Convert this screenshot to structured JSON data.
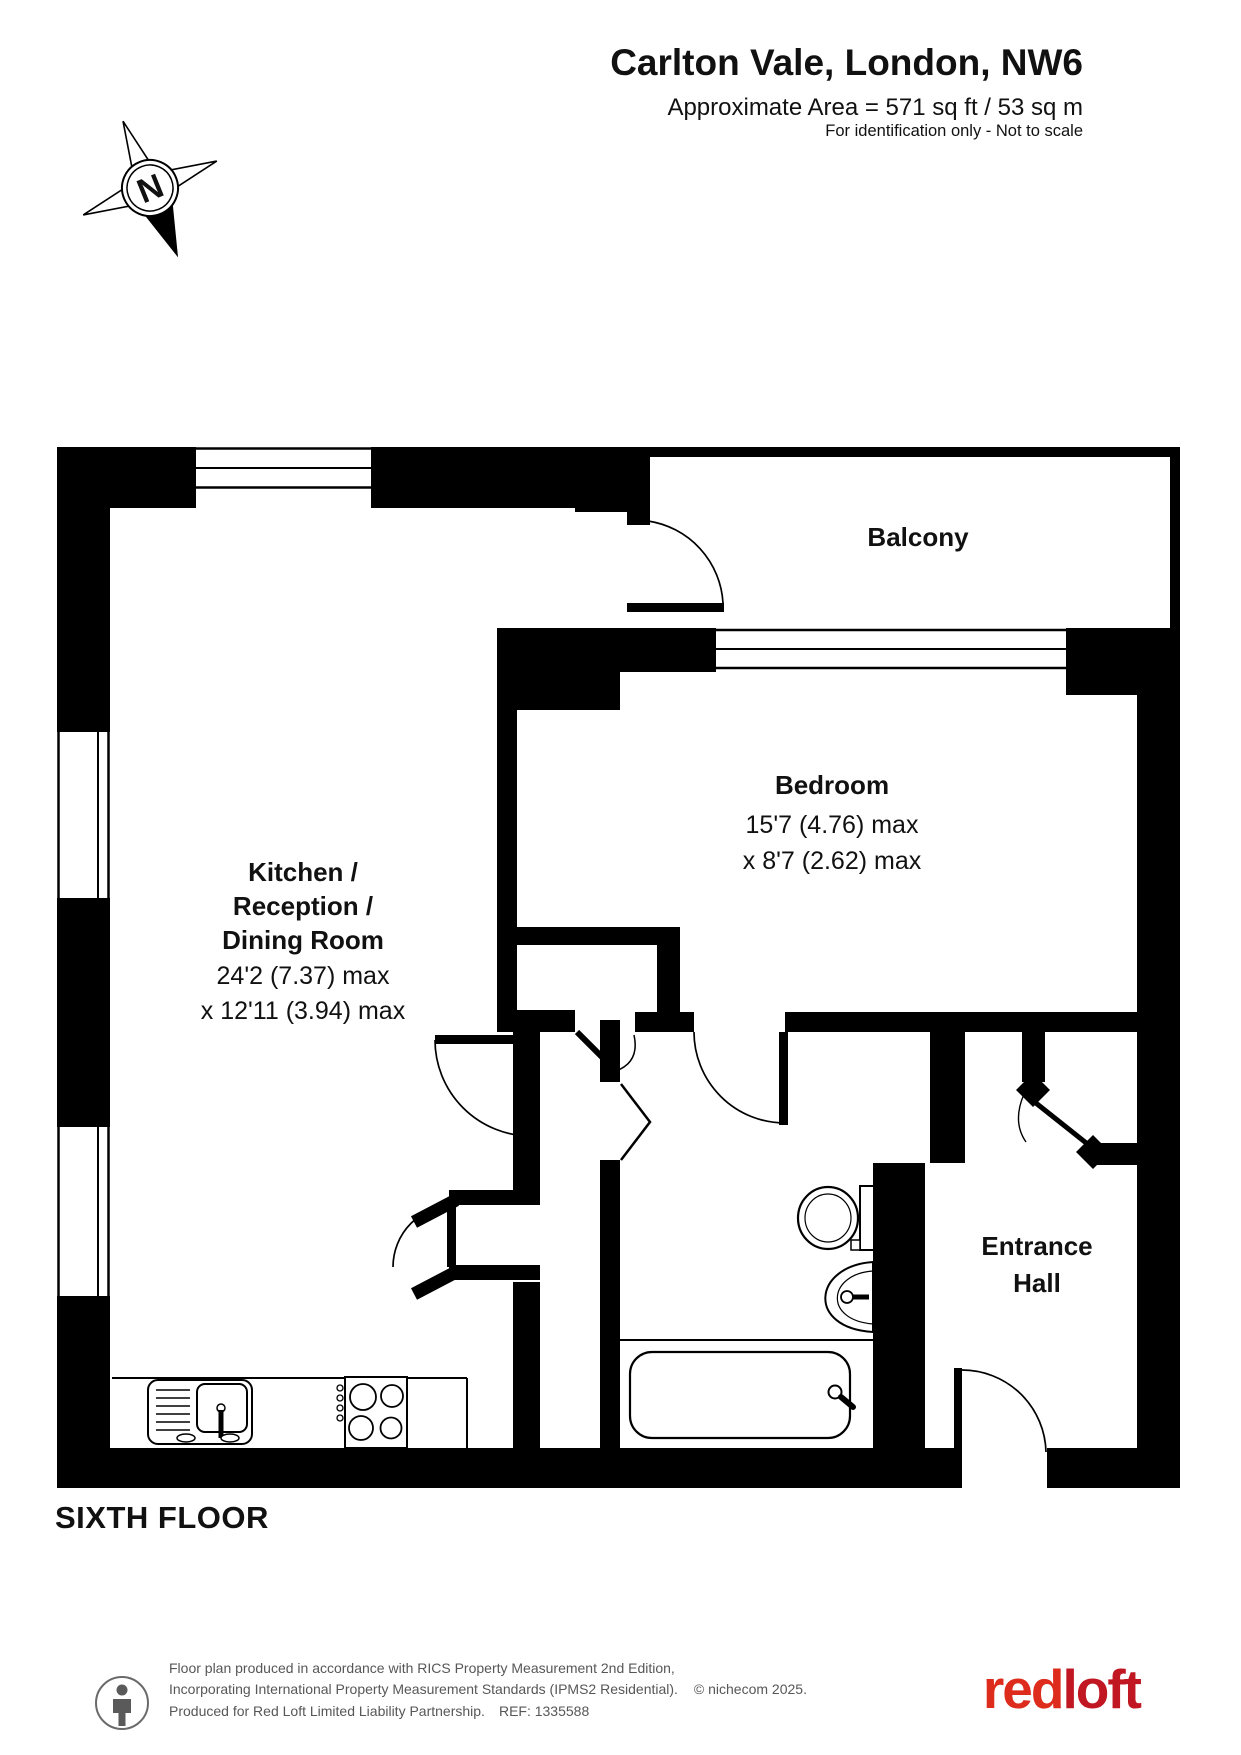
{
  "header": {
    "address": "Carlton Vale, London, NW6",
    "area": "Approximate Area = 571 sq ft / 53 sq m",
    "note": "For identification only - Not to scale"
  },
  "compass": {
    "label": "N"
  },
  "rooms": {
    "balcony": {
      "name": "Balcony"
    },
    "bedroom": {
      "name": "Bedroom",
      "dim1": "15'7 (4.76) max",
      "dim2": "x 8'7 (2.62) max"
    },
    "kitchen": {
      "line1": "Kitchen /",
      "line2": "Reception /",
      "line3": "Dining Room",
      "dim1": "24'2 (7.37) max",
      "dim2": "x 12'11 (3.94) max"
    },
    "entrance_hall": {
      "line1": "Entrance",
      "line2": "Hall"
    }
  },
  "floor_label": "SIXTH FLOOR",
  "footer": {
    "line1": "Floor plan produced in accordance with RICS Property Measurement 2nd Edition,",
    "line2": "Incorporating International Property Measurement Standards (IPMS2 Residential).",
    "copyright": "© nichecom 2025.",
    "line3": "Produced for Red Loft Limited Liability Partnership.",
    "ref": "REF:  1335588",
    "logo_red": "red",
    "logo_loft": "loft"
  },
  "colors": {
    "wall": "#000000",
    "logo_red": "#dd2b1c",
    "logo_loft": "#c01722",
    "footer_text": "#575757"
  }
}
